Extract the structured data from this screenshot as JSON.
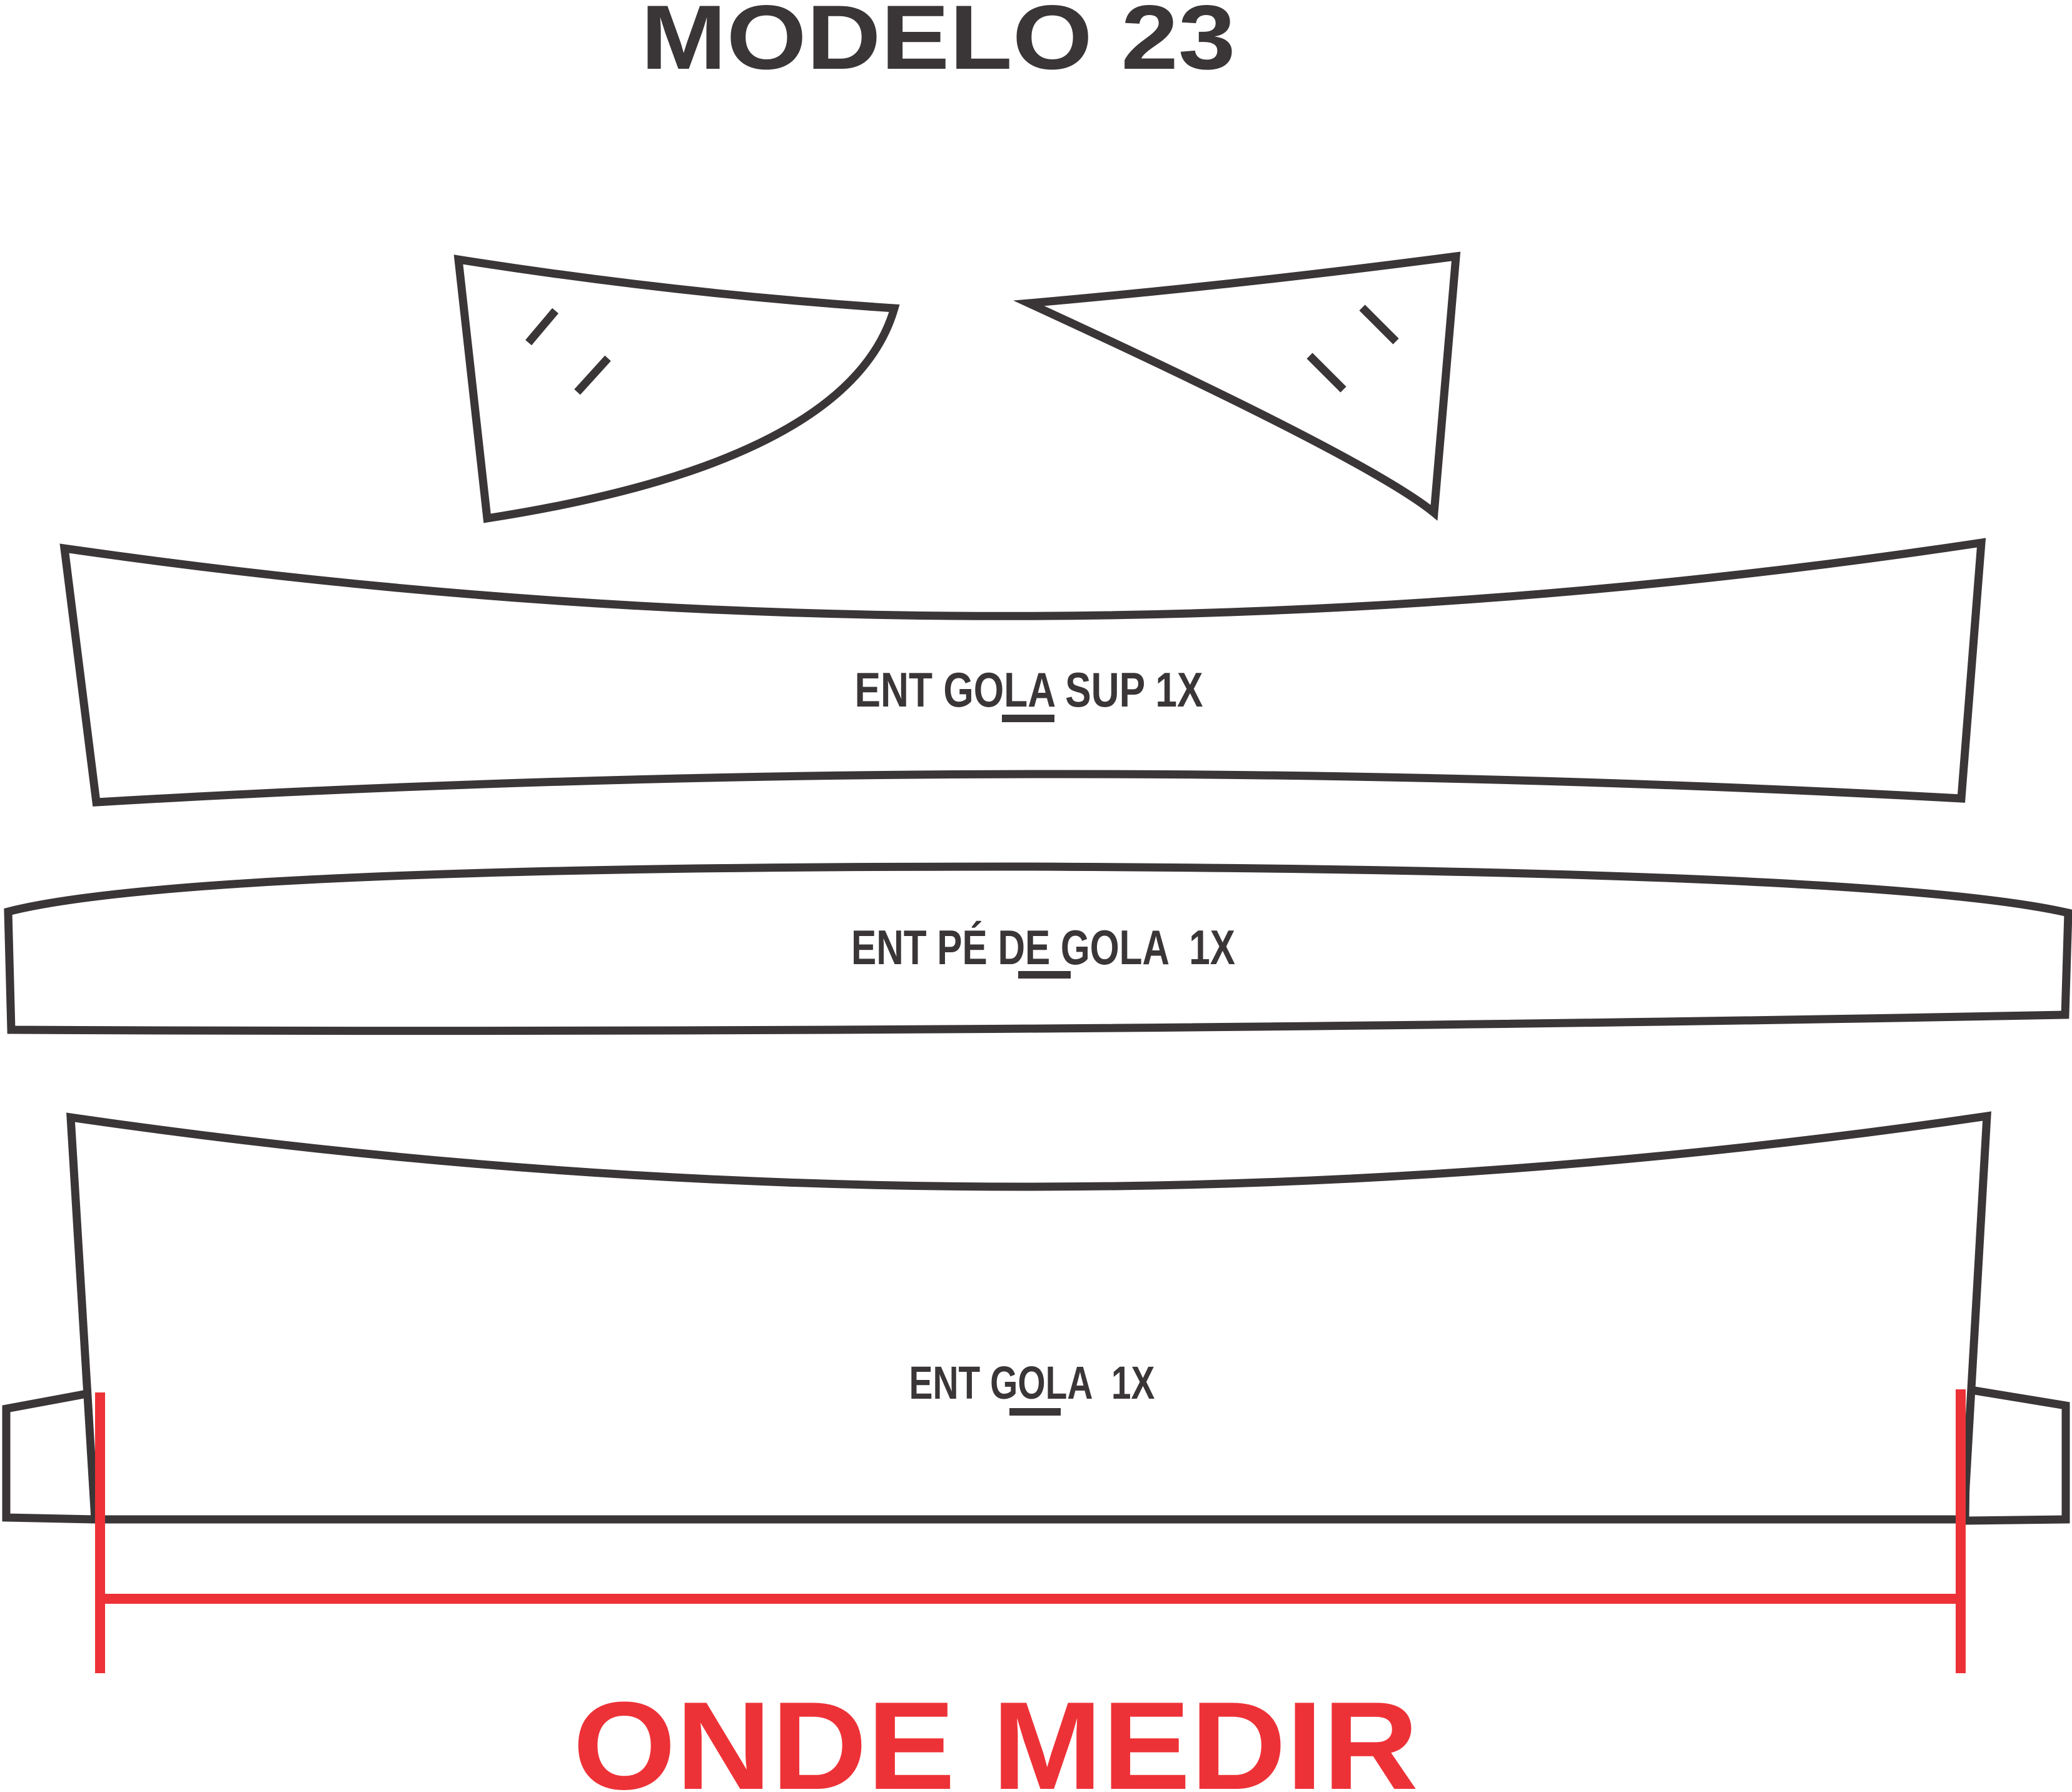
{
  "title": "MODELO 23",
  "labels": {
    "collar_top": "ENT GOLA SUP 1X",
    "collar_stand": "ENT PÉ DE GOLA  1X",
    "collar_main": "ENT GOLA  1X"
  },
  "measurement": {
    "caption": "ONDE MEDIR"
  },
  "pieces": [
    {
      "name": "collar point left",
      "quantity": ""
    },
    {
      "name": "collar point right",
      "quantity": ""
    },
    {
      "name": "ENT GOLA SUP",
      "quantity": "1X"
    },
    {
      "name": "ENT PÉ DE GOLA",
      "quantity": "1X"
    },
    {
      "name": "ENT GOLA",
      "quantity": "1X"
    }
  ],
  "colors": {
    "outline": "#3a3537",
    "red": "#ed3237",
    "background": "#ffffff"
  }
}
